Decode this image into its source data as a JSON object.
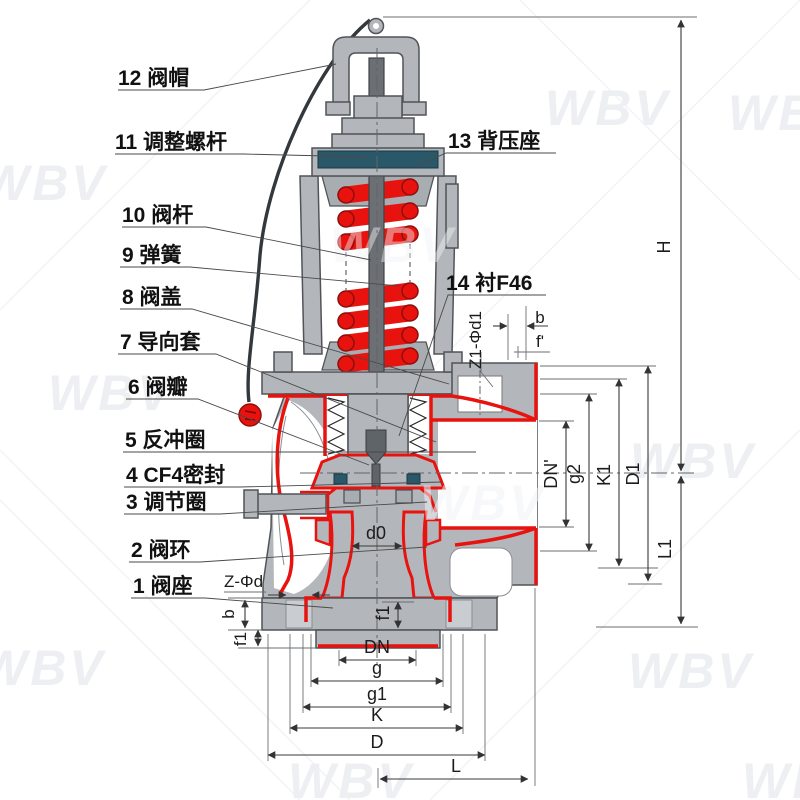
{
  "watermark": {
    "text": "WBV"
  },
  "parts": [
    {
      "label": "1 阀座"
    },
    {
      "label": "2 阀环"
    },
    {
      "label": "3 调节圈"
    },
    {
      "label": "4 CF4密封"
    },
    {
      "label": "5 反冲圈"
    },
    {
      "label": "6 阀瓣"
    },
    {
      "label": "7 导向套"
    },
    {
      "label": "8 阀盖"
    },
    {
      "label": "9 弹簧"
    },
    {
      "label": "10 阀杆"
    },
    {
      "label": "11 调整螺杆"
    },
    {
      "label": "12 阀帽"
    },
    {
      "label": "13 背压座"
    },
    {
      "label": "14 衬F46"
    }
  ],
  "dims": {
    "dn": "DN",
    "g": "g",
    "g1": "g1",
    "k": "K",
    "d": "D",
    "l": "L",
    "d0": "d0",
    "f1_center": "f1",
    "f1_left": "f1",
    "b_left": "b",
    "z_phi_d": "Z-Φd",
    "dn_prime": "DN'",
    "g2": "g2",
    "k1": "K1",
    "d1": "D1",
    "h": "H",
    "l1": "L1",
    "z1_phi_d1": "Z1-Φd1",
    "b_top": "b",
    "f_prime": "f'"
  }
}
